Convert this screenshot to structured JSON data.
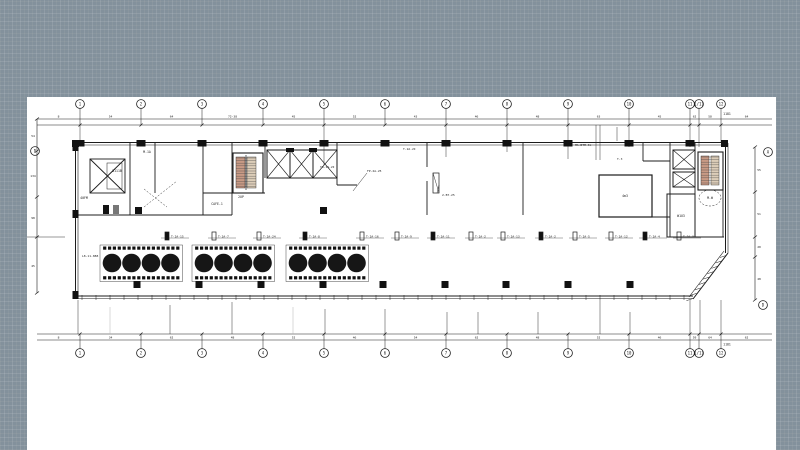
{
  "app": {
    "view": "floor-plan-drawing"
  },
  "colors": {
    "background": "#83919c",
    "canvas": "#ffffff",
    "ink": "#1c1c1c",
    "stair_tread_warm": "#c89a85",
    "stair_tread_light": "#dccdb8"
  },
  "grid": {
    "top_labels": [
      "1",
      "2",
      "3",
      "4",
      "5",
      "6",
      "7",
      "8",
      "9",
      "10",
      "11",
      "1/11",
      "12"
    ],
    "bottom_labels": [
      "1",
      "2",
      "3",
      "4",
      "5",
      "6",
      "7",
      "8",
      "9",
      "10",
      "11",
      "1/11",
      "12"
    ],
    "side_labels": {
      "left": "D",
      "right_top": "A",
      "right_bottom": "D"
    },
    "overall_dim_top": "1181",
    "overall_dim_bottom": "1181"
  },
  "dims": {
    "top_chain": [
      "8",
      "54",
      "64",
      "72-38",
      "45",
      "52",
      "43",
      "46",
      "48",
      "63",
      "45",
      "62",
      "58",
      "64"
    ],
    "bottom_chain": [
      "8",
      "34",
      "62",
      "48",
      "52",
      "46",
      "54",
      "62",
      "48",
      "52",
      "46",
      "59",
      "64",
      "62"
    ],
    "left_chain": [
      "54",
      "134",
      "98",
      "45"
    ],
    "right_chain": [
      "55",
      "51",
      "20",
      "48"
    ]
  },
  "equipment": {
    "labels": [
      "T-2A-15",
      "T-2A-7",
      "T-2A-24",
      "T-2A-8",
      "T-2A-16",
      "T-2A-9",
      "T-2A-11",
      "T-2A-2",
      "T-2A-13",
      "T-2A-2",
      "T-2A-5",
      "T-2A-12",
      "T-2A-4",
      "T-2A-3"
    ]
  },
  "rooms": {
    "upper_left": "40FM",
    "left_small": "B111B",
    "stair_left": "2UP",
    "cafe": "CAFE-1",
    "machine": "M-1A",
    "right_large": "4m3",
    "right_small": "W1U3",
    "stair_right": "M.W"
  },
  "annotations": [
    {
      "text": "TU-1A-2I"
    },
    {
      "text": "FP-2A-25"
    },
    {
      "text": "T-2A-2I"
    },
    {
      "text": "2-BT-25"
    },
    {
      "text": "MA-BTM-4k"
    },
    {
      "text": "T-3"
    },
    {
      "text": "L8-11-888"
    }
  ],
  "hall": {
    "table_groups": 3,
    "tables_per_group": 4,
    "chairs_per_side": 4
  }
}
